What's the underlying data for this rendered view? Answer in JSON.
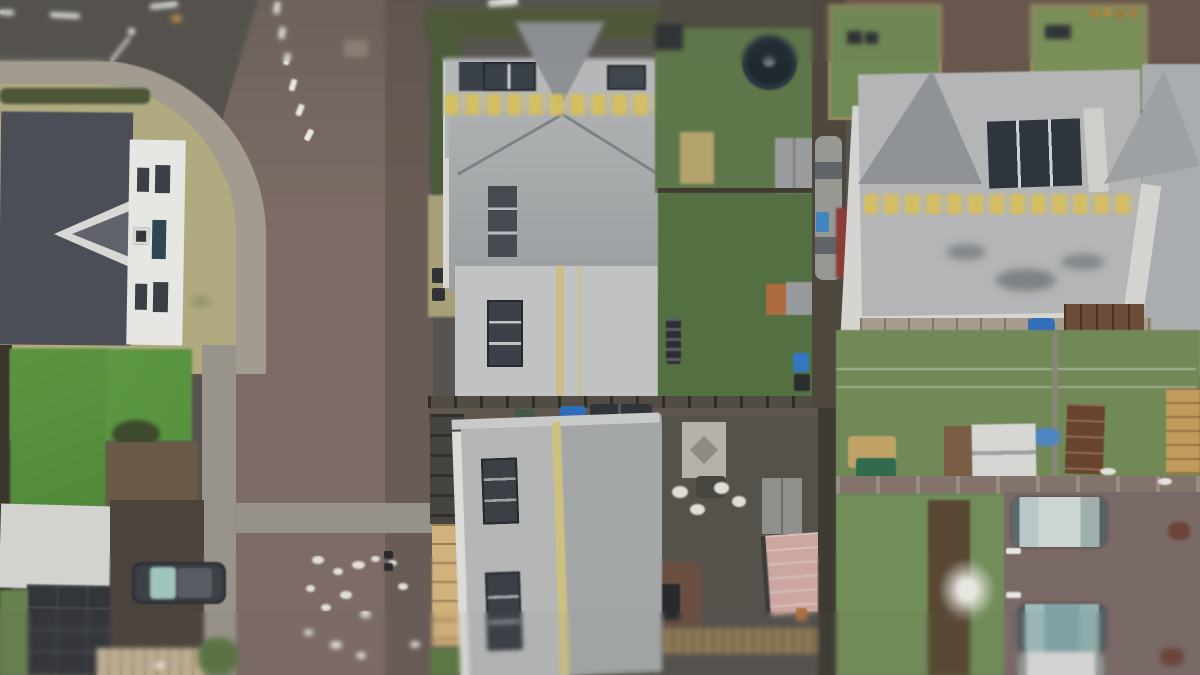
{
  "scene": {
    "type": "aerial-drone-photograph",
    "description": "Top-down overcast aerial view of a residential neighbourhood: grey-roofed detached houses with rear gardens, a dark tarmac road curving at the top-left into a red block-paved street running vertically, back gardens with sheds, a trampoline, bright artificial turf, parked cars, bins, a pink garden building and a brown parking court with three parked cars at the lower right. Tilt-shift style blur at top and bottom edges.",
    "visible_text": [],
    "effects": [
      "tilt-shift blur",
      "soft photographic focus"
    ]
  },
  "palette": {
    "asphalt": "#56534d",
    "paved_road": "#7d6b65",
    "paved_road_dark": "#6e615a",
    "sidewalk": "#a29c8e",
    "dry_lawn": "#b2aa7c",
    "artificial_turf": "#5d9c40",
    "garden_lawn": "#6f8a54",
    "dark_garden_lawn": "#52703f",
    "roof_light_grey": "#b6b8ba",
    "roof_mid_grey": "#a4a7a9",
    "roof_dark_slate": "#4a4e57",
    "solar_panel": "#2e343c",
    "lichen_yellow": "#d2ba5a",
    "white_facade": "#e7e7e4",
    "fence_brown": "#6d4b33",
    "tan_wall": "#d4b178",
    "pink_shed": "#cfa7a0",
    "blue_car": "#2e6fc0",
    "teal_car": "#7fa3a8",
    "white_car": "#d9dad8",
    "dark_car": "#3b4046",
    "hedge_green": "#4d5836",
    "trampoline": "#1f2730"
  },
  "objects": [
    "tarmac-road-top-left",
    "red-paved-street",
    "curved-pavement",
    "pedestrian-crossing-band",
    "left-house-slate-roof",
    "left-house-white-facade",
    "artificial-turf-garden",
    "white-garage-roof",
    "dark-garage-roof",
    "driveway-parked-car",
    "centre-house-hipped-roof",
    "centre-house-rooflights",
    "centre-house-extension",
    "rear-garden-trampoline",
    "garden-sheds",
    "wheelie-bins",
    "bottom-house-roof-with-lichen-ridge",
    "courtyard-patio",
    "pink-garden-building",
    "timber-deck",
    "right-semi-detached-roofs",
    "solar-panel-array",
    "clothesline-lawn",
    "white-shed",
    "brown-gate",
    "parking-court",
    "parked-suv",
    "parked-teal-car",
    "parked-white-car",
    "bird-droppings-on-road",
    "street-lamp",
    "blossom-shrub"
  ]
}
